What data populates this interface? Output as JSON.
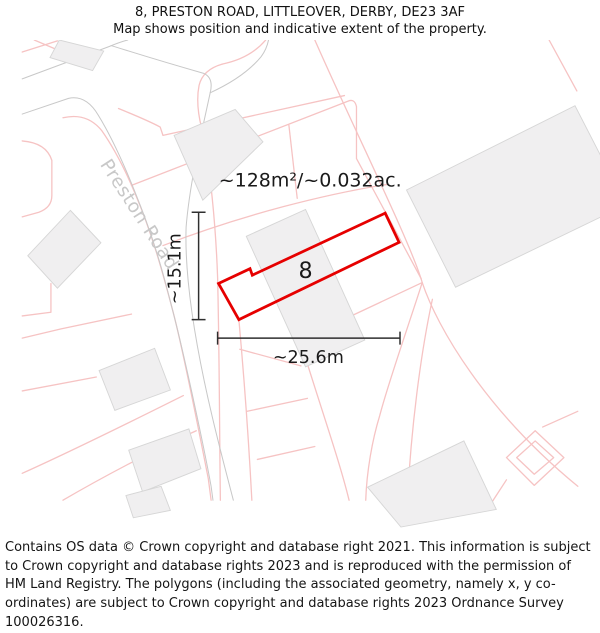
{
  "title": {
    "line1": "8, PRESTON ROAD, LITTLEOVER, DERBY, DE23 3AF",
    "line2": "Map shows position and indicative extent of the property."
  },
  "map": {
    "road_label": "Preston Road",
    "plot_number": "8",
    "area_label": "~128m²/~0.032ac.",
    "width_label": "~25.6m",
    "height_label": "~15.1m",
    "colors": {
      "plot_outline": "#e60000",
      "parcel_line": "#f6c3c3",
      "road_edge": "#c8c8c8",
      "building_fill": "#f0eff0",
      "building_stroke": "#d6d6d6",
      "dimension_line": "#2f2f2f",
      "road_label": "#c8c8c8",
      "label_text": "#1a1a1a"
    }
  },
  "footer": {
    "text": "Contains OS data © Crown copyright and database right 2021. This information is subject to Crown copyright and database rights 2023 and is reproduced with the permission of HM Land Registry. The polygons (including the associated geometry, namely x, y co-ordinates) are subject to Crown copyright and database rights 2023 Ordnance Survey 100026316."
  }
}
